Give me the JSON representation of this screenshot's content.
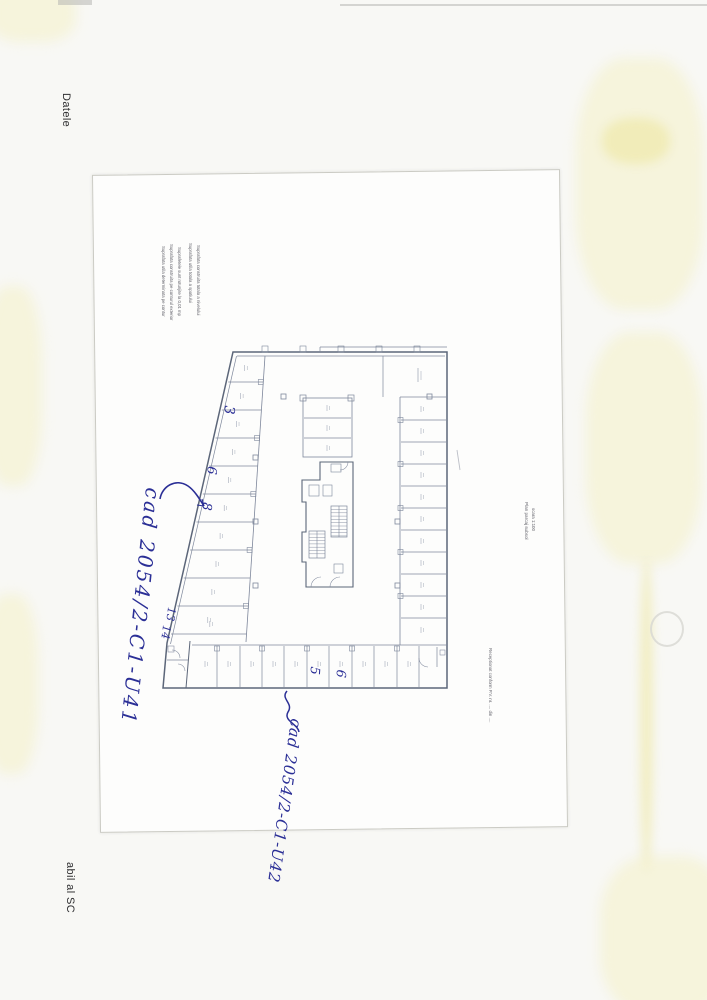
{
  "scan": {
    "edge_texts": {
      "top_left_vertical": "Datele",
      "bottom_left_vertical": "abil al SC"
    },
    "highlight_color": "#f4f1c6",
    "paper_edge_color": "#cbcbc4"
  },
  "paper": {
    "notes_block": {
      "lines": [
        "Suprafata utila determinata pe contur",
        "Suprafata construita pe conturul exterior",
        "Suprafetele sunt rotunjite la 0,01 mp",
        "Suprafata utila totala a spatiului",
        "Suprafata construita totala a nivelului"
      ]
    },
    "title_block": {
      "line1": "Plan parcaj subsol",
      "line2": "scara 1:100"
    },
    "side_note": "Receptionat conform P.V. nr. .... din ...."
  },
  "plan": {
    "line_color": "#6b7489",
    "ink_color": "#2b2f96",
    "handwritten": {
      "annotation_left": "cad 2054/2-C1-U41",
      "annotation_bottom": "cad 2054/2-C1-U42",
      "stall_numbers": {
        "n3": "3",
        "n6": "6",
        "n8": "8",
        "n13": "13",
        "n14": "14",
        "n5": "5",
        "n6b": "6"
      }
    }
  }
}
